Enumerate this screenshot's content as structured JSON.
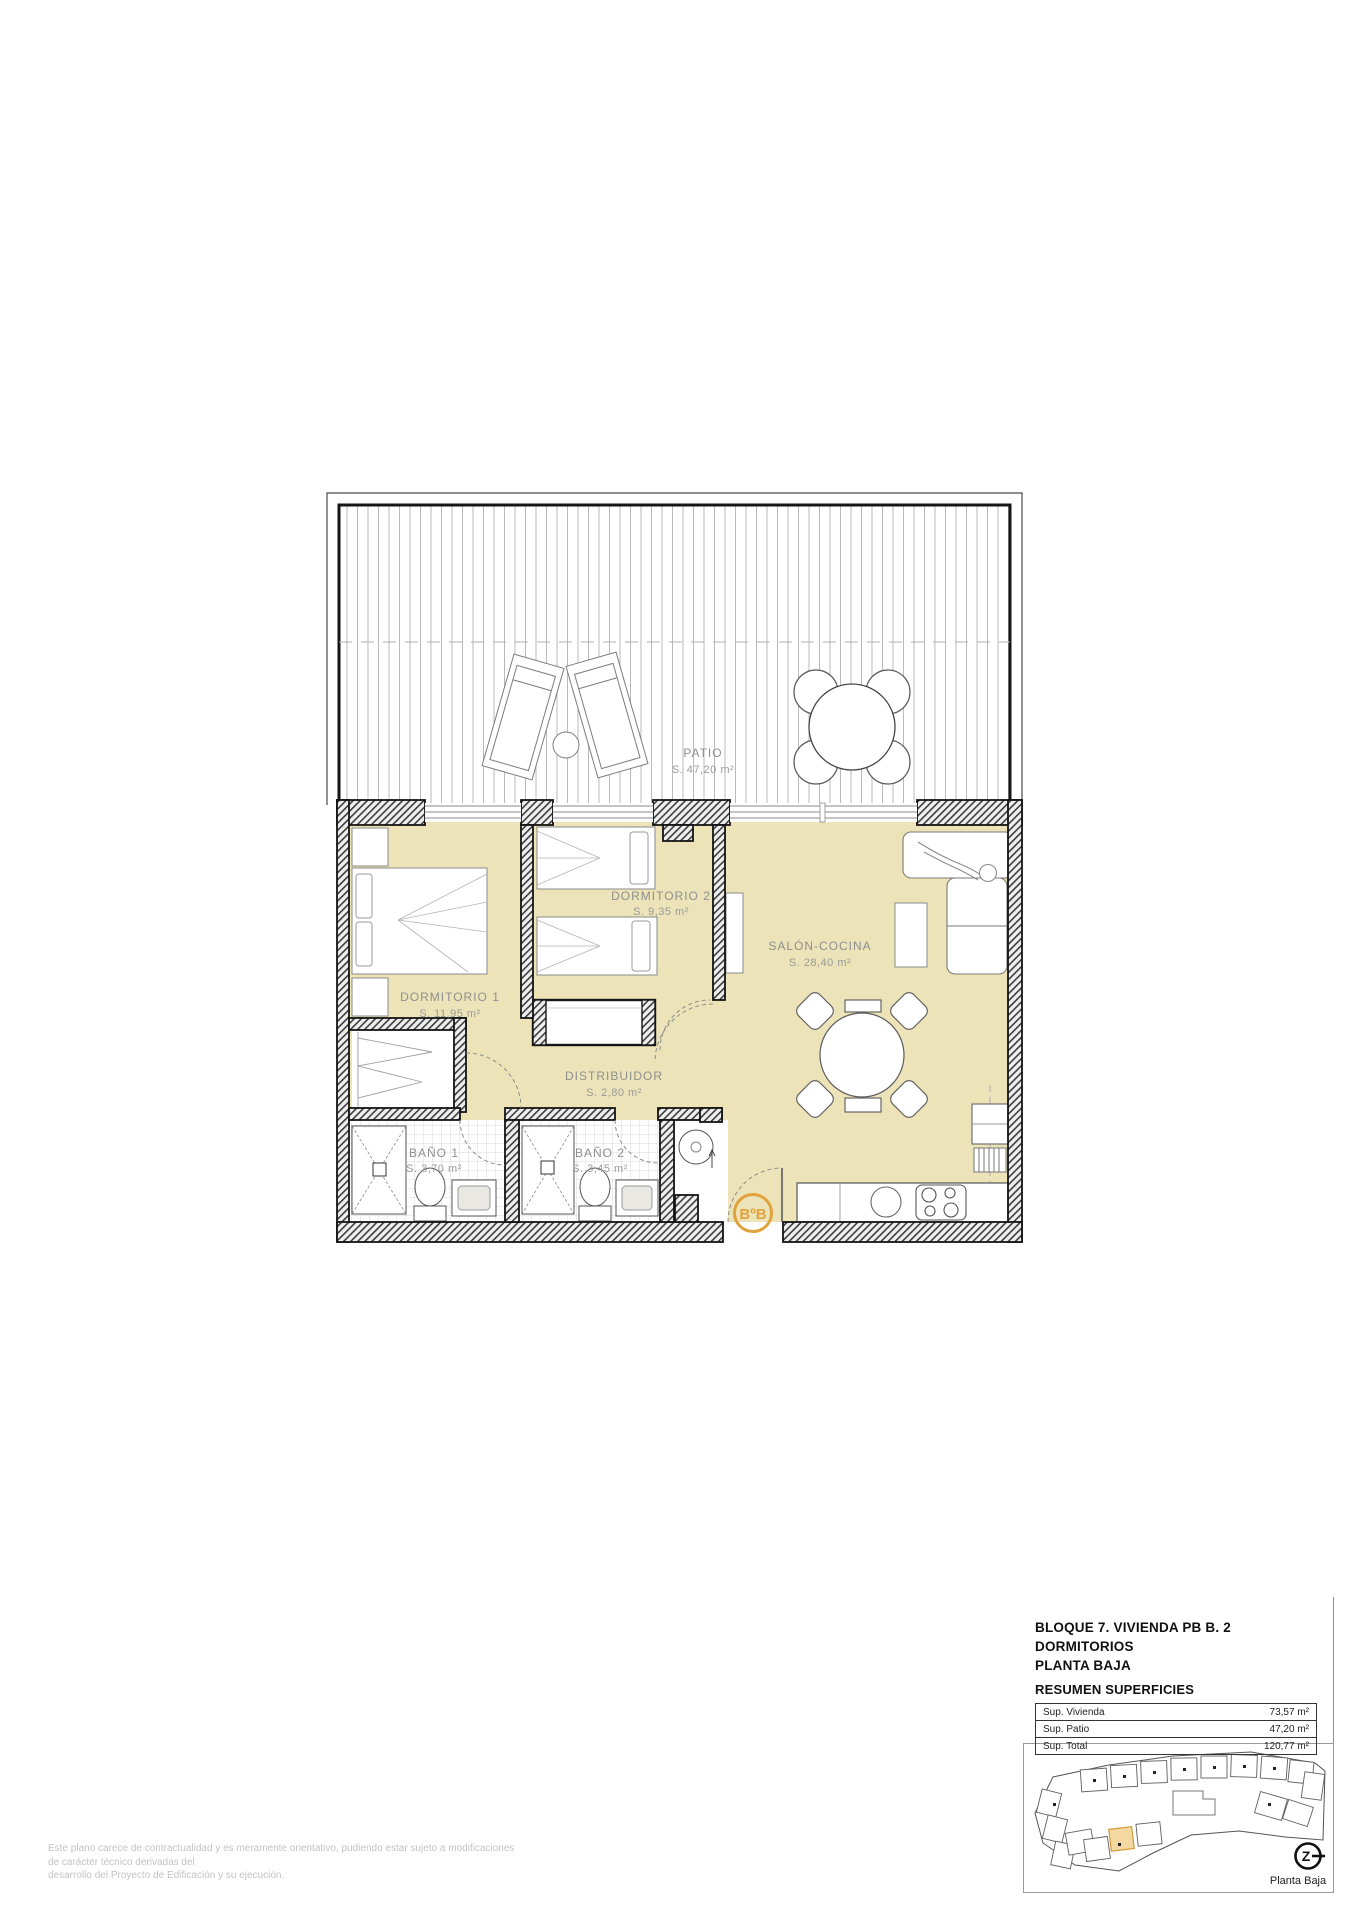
{
  "plan": {
    "rooms": {
      "patio": {
        "name": "PATIO",
        "area": "S. 47,20 m²"
      },
      "dormitorio1": {
        "name": "DORMITORIO 1",
        "area": "S. 11,95 m²"
      },
      "dormitorio2": {
        "name": "DORMITORIO 2",
        "area": "S. 9,35 m²"
      },
      "salon_cocina": {
        "name": "SALÓN-COCINA",
        "area": "S. 28,40 m²"
      },
      "distribuidor": {
        "name": "DISTRIBUIDOR",
        "area": "S. 2,80 m²"
      },
      "bano1": {
        "name": "BAÑO 1",
        "area": "S. 3,70 m²"
      },
      "bano2": {
        "name": "BAÑO 2",
        "area": "S. 3,45 m²"
      }
    },
    "entry_badge": "BºB",
    "compass_letter": "Z"
  },
  "title_block": {
    "line1": "BLOQUE 7. VIVIENDA PB B. 2 DORMITORIOS",
    "line2": "PLANTA BAJA",
    "line3": "RESUMEN SUPERFICIES",
    "table": {
      "rows": [
        {
          "label": "Sup. Vivienda",
          "value": "73,57 m²"
        },
        {
          "label": "Sup. Patio",
          "value": "47,20 m²"
        },
        {
          "label": "Sup. Total",
          "value": "120,77 m²"
        }
      ]
    }
  },
  "site_plan": {
    "caption": "Planta Baja"
  },
  "disclaimer": {
    "line1": "Este plano carece de contractualidad y es meramente orientativo, pudiendo estar sujeto a modificaciones de carácter técnico derivadas del",
    "line2": "desarrollo del Proyecto de Edificación y su ejecución."
  },
  "colors": {
    "floor": "#ECE4B8",
    "accent": "#E2A23C",
    "wall_line": "#141414"
  }
}
